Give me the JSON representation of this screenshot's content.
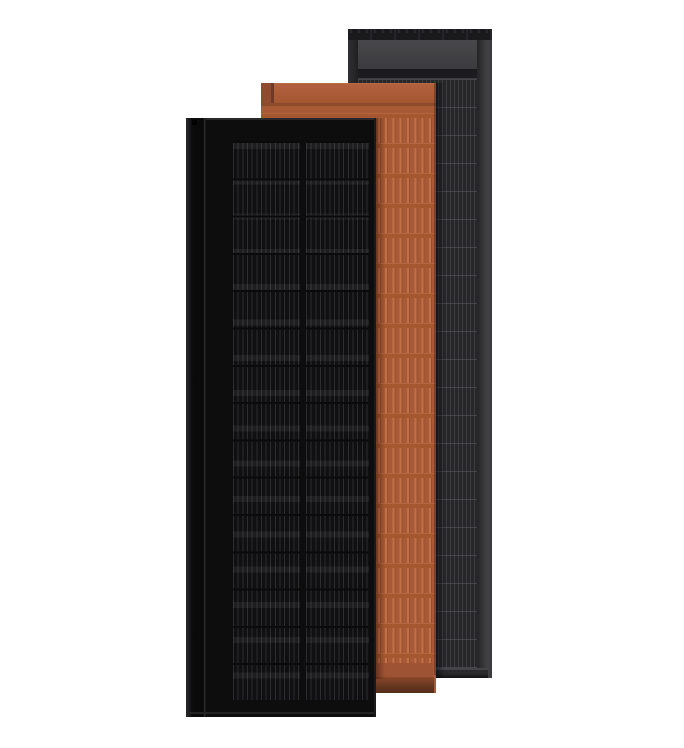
{
  "image": {
    "type": "product-render",
    "subject": "three overlapping solar roof panels",
    "text_content": ""
  },
  "theme": {
    "background": "#ffffff",
    "matte-black-surface": "#0d0d0e",
    "matte-black-stripe": "#2c2c2f",
    "terracotta-surface": "#a85a36",
    "terracotta-seam": "#8d4a2d",
    "terracotta-shadow": "#552d1a",
    "slate-gray-surface": "#27272a",
    "slate-gray-stripe": "#3c3c3f",
    "slate-gray-cap": "#1a1a1c"
  },
  "panels": [
    {
      "id": "slate-gray",
      "position": "back",
      "finish": "dark gray striped cell grid with gray header flashing"
    },
    {
      "id": "terracotta",
      "position": "middle",
      "finish": "terracotta ribbed tile with header strip"
    },
    {
      "id": "matte-black",
      "position": "front",
      "finish": "black solar cell grid, two columns, left mounting flange"
    }
  ]
}
